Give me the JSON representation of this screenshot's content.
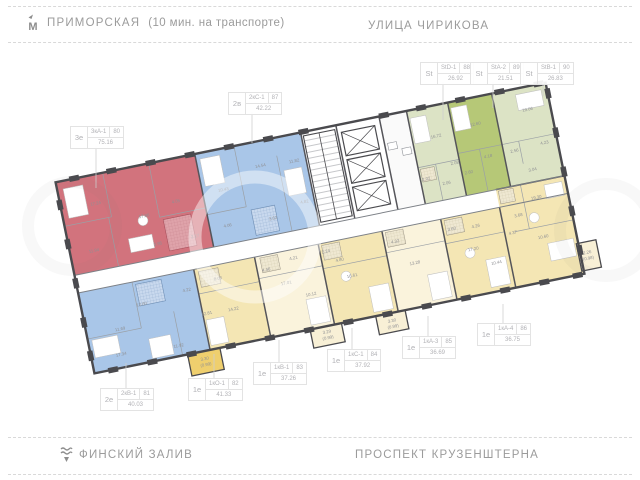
{
  "streets": {
    "top_left": {
      "name": "ПРИМОРСКАЯ",
      "note": "(10 мин. на транспорте)"
    },
    "top_right": {
      "name": "УЛИЦА ЧИРИКОВА"
    },
    "bottom_left": {
      "name": "ФИНСКИЙ ЗАЛИВ"
    },
    "bottom_right": {
      "name": "ПРОСПЕКТ КРУЗЕНШТЕРНА"
    }
  },
  "icons": {
    "metro": "М",
    "water": "wave-with-down-arrow"
  },
  "colors": {
    "selected_red": "#d2737d",
    "blue": "#a9c6e8",
    "green_bright": "#b6c877",
    "green_pale": "#dce3c5",
    "yellow": "#f4e6b4",
    "cream": "#faf3dc",
    "balcony_yellow": "#efcf6e",
    "walls": "#4a4a4e",
    "label_text": "#b2b2b6",
    "street_text": "#9b9b9b",
    "room_text": "#8f9094"
  },
  "callouts": [
    {
      "id": "3e",
      "prefix": "3е",
      "code": "3кА-1",
      "num": "80",
      "area": "75.16",
      "x": 70,
      "y": 126,
      "lx": 96,
      "ly1": 146,
      "ly2": 188
    },
    {
      "id": "2v",
      "prefix": "2в",
      "code": "2кС-1",
      "num": "87",
      "area": "42.22",
      "x": 228,
      "y": 92,
      "lx": 252,
      "ly1": 112,
      "ly2": 143
    },
    {
      "id": "st1",
      "prefix": "St",
      "code": "StD-1",
      "num": "88",
      "area": "26.92",
      "x": 420,
      "y": 62,
      "lx": 443,
      "ly1": 82,
      "ly2": 120
    },
    {
      "id": "st2",
      "prefix": "St",
      "code": "StA-2",
      "num": "89",
      "area": "21.51",
      "x": 470,
      "y": 62,
      "lx": 493,
      "ly1": 82,
      "ly2": 108
    },
    {
      "id": "st3",
      "prefix": "St",
      "code": "StB-1",
      "num": "90",
      "area": "26.83",
      "x": 520,
      "y": 62,
      "lx": 543,
      "ly1": 82,
      "ly2": 96
    },
    {
      "id": "2e",
      "prefix": "2е",
      "code": "2кВ-1",
      "num": "81",
      "area": "40.03",
      "x": 100,
      "y": 388,
      "lx": 126,
      "ly1": 388,
      "ly2": 363
    },
    {
      "id": "1e82",
      "prefix": "1е",
      "code": "1кО-1",
      "num": "82",
      "area": "41.33",
      "x": 188,
      "y": 378,
      "lx": 214,
      "ly1": 378,
      "ly2": 354
    },
    {
      "id": "1e83",
      "prefix": "1е",
      "code": "1кВ-1",
      "num": "83",
      "area": "37.26",
      "x": 253,
      "y": 362,
      "lx": 279,
      "ly1": 362,
      "ly2": 340
    },
    {
      "id": "1e84",
      "prefix": "1е",
      "code": "1кС-1",
      "num": "84",
      "area": "37.92",
      "x": 327,
      "y": 349,
      "lx": 352,
      "ly1": 349,
      "ly2": 328
    },
    {
      "id": "1e85",
      "prefix": "1е",
      "code": "1кА-3",
      "num": "85",
      "area": "36.69",
      "x": 402,
      "y": 336,
      "lx": 428,
      "ly1": 336,
      "ly2": 316
    },
    {
      "id": "1e86",
      "prefix": "1е",
      "code": "1кА-4",
      "num": "86",
      "area": "36.75",
      "x": 477,
      "y": 323,
      "lx": 503,
      "ly1": 323,
      "ly2": 304
    }
  ],
  "plan": {
    "room_labels": [
      {
        "x": 35,
        "y": 30,
        "t": "17.24"
      },
      {
        "x": 80,
        "y": 52,
        "t": "17.86"
      },
      {
        "x": 24,
        "y": 76,
        "t": "11.94"
      },
      {
        "x": 114,
        "y": 44,
        "t": "4.05"
      },
      {
        "x": 88,
        "y": 82,
        "t": "3.95"
      },
      {
        "x": 126,
        "y": 82,
        "t": "2.17"
      },
      {
        "x": 163,
        "y": 42,
        "t": "10.43"
      },
      {
        "x": 204,
        "y": 26,
        "t": "14.54"
      },
      {
        "x": 238,
        "y": 28,
        "t": "11.82"
      },
      {
        "x": 160,
        "y": 78,
        "t": "4.06"
      },
      {
        "x": 240,
        "y": 70,
        "t": "4.82"
      },
      {
        "x": 206,
        "y": 80,
        "t": "3.62"
      },
      {
        "x": 382,
        "y": 32,
        "t": "16.72"
      },
      {
        "x": 364,
        "y": 72,
        "t": "2.02"
      },
      {
        "x": 383,
        "y": 80,
        "t": "2.06"
      },
      {
        "x": 395,
        "y": 62,
        "t": "2.08"
      },
      {
        "x": 423,
        "y": 28,
        "t": "12.60"
      },
      {
        "x": 429,
        "y": 62,
        "t": "4.18"
      },
      {
        "x": 407,
        "y": 74,
        "t": "2.60"
      },
      {
        "x": 477,
        "y": 24,
        "t": "19.06"
      },
      {
        "x": 487,
        "y": 60,
        "t": "4.23"
      },
      {
        "x": 456,
        "y": 62,
        "t": "2.56"
      },
      {
        "x": 470,
        "y": 84,
        "t": "3.04"
      },
      {
        "x": 468,
        "y": 112,
        "t": "19.30"
      },
      {
        "x": 447,
        "y": 126,
        "t": "3.68"
      },
      {
        "x": 467,
        "y": 152,
        "t": "10.60"
      },
      {
        "x": 438,
        "y": 142,
        "t": "4.37"
      },
      {
        "x": 396,
        "y": 150,
        "t": "17.20"
      },
      {
        "x": 379,
        "y": 126,
        "t": "3.60"
      },
      {
        "x": 403,
        "y": 128,
        "t": "4.26"
      },
      {
        "x": 416,
        "y": 168,
        "t": "10.44"
      },
      {
        "x": 336,
        "y": 152,
        "t": "13.28"
      },
      {
        "x": 321,
        "y": 127,
        "t": "4.32"
      },
      {
        "x": 272,
        "y": 152,
        "t": "16.61"
      },
      {
        "x": 251,
        "y": 123,
        "t": "2.24"
      },
      {
        "x": 263,
        "y": 134,
        "t": "4.80"
      },
      {
        "x": 206,
        "y": 146,
        "t": "17.01"
      },
      {
        "x": 228,
        "y": 162,
        "t": "10.12"
      },
      {
        "x": 189,
        "y": 129,
        "t": "4.46"
      },
      {
        "x": 218,
        "y": 123,
        "t": "4.21"
      },
      {
        "x": 149,
        "y": 161,
        "t": "14.22"
      },
      {
        "x": 122,
        "y": 160,
        "t": "12.81"
      },
      {
        "x": 140,
        "y": 128,
        "t": "8.06"
      },
      {
        "x": 60,
        "y": 138,
        "t": "12.60"
      },
      {
        "x": 34,
        "y": 158,
        "t": "11.69"
      },
      {
        "x": 30,
        "y": 183,
        "t": "17.34"
      },
      {
        "x": 88,
        "y": 186,
        "t": "11.92"
      },
      {
        "x": 107,
        "y": 133,
        "t": "4.22"
      },
      {
        "x": 111,
        "y": 204,
        "t": "3.30"
      },
      {
        "x": 111,
        "y": 210,
        "t": "(0.99)"
      },
      {
        "x": 236,
        "y": 202,
        "t": "3.29"
      },
      {
        "x": 236,
        "y": 208,
        "t": "(0.99)"
      },
      {
        "x": 302,
        "y": 204,
        "t": "3.30"
      },
      {
        "x": 302,
        "y": 210,
        "t": "(0.99)"
      },
      {
        "x": 507,
        "y": 176,
        "t": "2.26"
      },
      {
        "x": 507,
        "y": 182,
        "t": "(0.98)"
      }
    ]
  }
}
